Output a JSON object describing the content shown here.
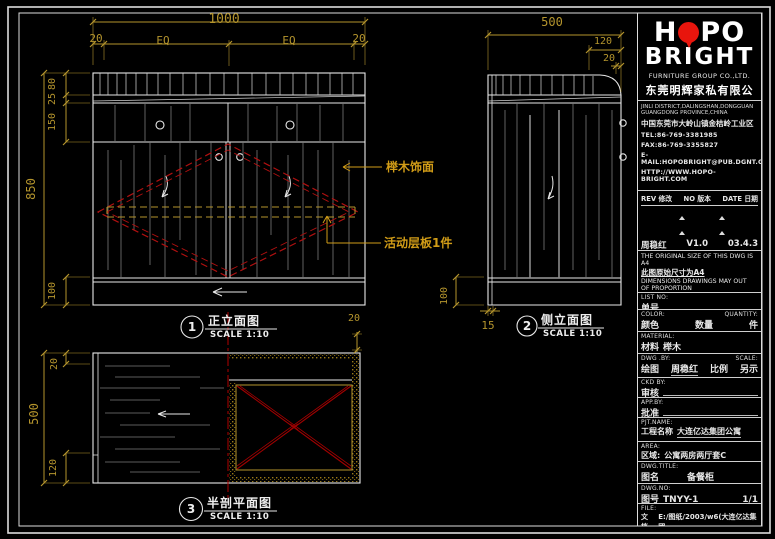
{
  "colors": {
    "background": "#000000",
    "line_white": "#e8e8e8",
    "grain_gray": "#7a7a7a",
    "dimension_yellow": "#b5952d",
    "label_orange": "#d19c17",
    "cad_red": "#b01010",
    "logo_red": "#e8150d"
  },
  "front": {
    "dim_total_w": "1000",
    "dim_seg_left": "20",
    "dim_eq1": "EQ",
    "dim_eq2": "EQ",
    "dim_seg_right": "20",
    "dim_total_h": "850",
    "dim_top": "80",
    "dim_band": "25",
    "dim_upper": "150",
    "dim_base": "100",
    "label_veneer": "榉木饰面",
    "label_shelf": "活动层板1件",
    "view_num": "1",
    "view_title": "正立面图",
    "view_scale": "SCALE 1:10"
  },
  "side": {
    "dim_depth": "500",
    "dim_120": "120",
    "dim_20": "20",
    "dim_base": "100",
    "dim_15": "15",
    "view_num": "2",
    "view_title": "侧立面图",
    "view_scale": "SCALE 1:10"
  },
  "plan": {
    "dim_depth": "500",
    "dim_top": "20",
    "dim_bottom": "120",
    "dim_right": "20",
    "view_num": "3",
    "view_title": "半剖平面图",
    "view_scale": "SCALE 1:10"
  },
  "titleblock": {
    "logo": {
      "h": "H",
      "po": "PO",
      "bright": "BRIGHT",
      "subtitle": "FURNITURE GROUP CO.,LTD.",
      "company_cn": "东莞明辉家私有限公司"
    },
    "address": {
      "en1": "JINLI DISTRICT,DALINGSHAN,DONGGUAN",
      "en2": "GUANGDONG PROVINCE,CHINA",
      "cn": "中国东莞市大岭山镇金桔岭工业区",
      "tel": "TEL:86-769-3381985",
      "fax": "FAX:86-769-3355827",
      "email": "E-MAIL:HOPOBRIGHT@PUB.DGNT.GD.CN",
      "web": "HTTP://WWW.HOPO-BRIGHT.COM"
    },
    "revision": {
      "header_rev": "REV 修改",
      "header_no": "NO 版本",
      "header_date": "DATE 日期",
      "row_name": "周稳红",
      "row_ver": "V1.0",
      "row_date": "03.4.3"
    },
    "notes": {
      "en1": "THE ORIGINAL SIZE OF THIS DWG IS A4",
      "cn1": "此图原始尺寸为A4",
      "en2": "DIMENSIONS DRAWINGS MAY OUT",
      "en3": "OF PROPORTION",
      "cn2": "尺寸与图纸比例会有出入"
    },
    "fields": {
      "list_no_en": "LIST NO:",
      "list_no_cn": "单号",
      "list_no_val": "",
      "color_en": "COLOR:",
      "color_cn": "颜色",
      "color_val": "",
      "qty_en": "QUANTITY:",
      "qty_cn": "数量",
      "qty_unit": "件",
      "material_en": "MATERIAL:",
      "material_cn": "材料",
      "material_val": "榉木",
      "dwgby_en": "DWG .BY:",
      "dwgby_cn": "绘图",
      "dwgby_val": "周稳红",
      "scale_en": "SCALE:",
      "scale_cn": "比例",
      "scale_val": "另示",
      "ckd_en": "CKD BY:",
      "ckd_cn": "审核",
      "ckd_val": "",
      "app_en": "APP.BY:",
      "app_cn": "批准",
      "app_val": "",
      "pjt_en": "PJT.NAME:",
      "pjt_cn": "工程名称",
      "pjt_val": "大连亿达集团公寓",
      "area_en": "AREA:",
      "area_cn": "区域:",
      "area_val": "公寓两房两厅套C",
      "title_en": "DWG.TITLE:",
      "title_cn": "图名",
      "title_val": "备餐柜",
      "no_en": "DWG.NO:",
      "no_cn": "图号",
      "no_val": "TNYY-1",
      "no_sheet": "1/1",
      "file_en": "FILE:",
      "file_cn": "文档",
      "file_val": "E:/图纸/2003/w6(大连亿达集团"
    }
  }
}
